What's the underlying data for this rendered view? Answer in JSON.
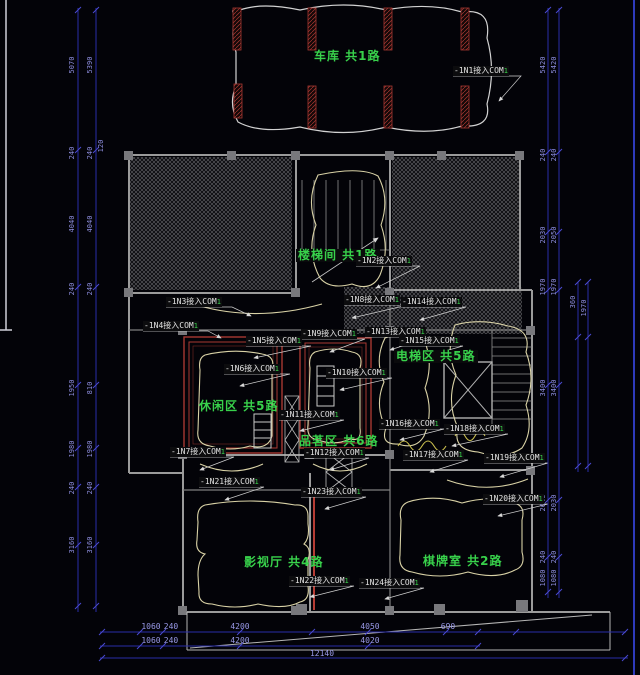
{
  "drawing": {
    "type": "electrical-floor-plan",
    "colors": {
      "room_label_green": "#38d14b",
      "wiring_red": "#a83832",
      "dimension_blue": "#2a2da8",
      "line_white": "#d6d6d6"
    }
  },
  "rooms": [
    {
      "label": "车库 共1路"
    },
    {
      "label": "楼梯间 共1路"
    },
    {
      "label": "电梯区 共5路"
    },
    {
      "label": "休闲区 共5路"
    },
    {
      "label": "品茗区 共6路"
    },
    {
      "label": "影视厅 共4路"
    },
    {
      "label": "棋牌室 共2路"
    }
  ],
  "circuits": [
    {
      "text": "-1N1接入COM",
      "sfx": "1"
    },
    {
      "text": "-1N2接入COM",
      "sfx": "1"
    },
    {
      "text": "-1N3接入COM",
      "sfx": "1"
    },
    {
      "text": "-1N4接入COM",
      "sfx": "1"
    },
    {
      "text": "-1N5接入COM",
      "sfx": "1"
    },
    {
      "text": "-1N6接入COM",
      "sfx": "1"
    },
    {
      "text": "-1N7接入COM",
      "sfx": "1"
    },
    {
      "text": "-1N8接入COM",
      "sfx": "1"
    },
    {
      "text": "-1N9接入COM",
      "sfx": "1"
    },
    {
      "text": "-1N10接入COM",
      "sfx": "1"
    },
    {
      "text": "-1N11接入COM",
      "sfx": "1"
    },
    {
      "text": "-1N12接入COM",
      "sfx": "1"
    },
    {
      "text": "-1N13接入COM",
      "sfx": "1"
    },
    {
      "text": "-1N14接入COM",
      "sfx": "1"
    },
    {
      "text": "-1N15接入COM",
      "sfx": "1"
    },
    {
      "text": "-1N16接入COM",
      "sfx": "1"
    },
    {
      "text": "-1N17接入COM",
      "sfx": "1"
    },
    {
      "text": "-1N18接入COM",
      "sfx": "1"
    },
    {
      "text": "-1N19接入COM",
      "sfx": "1"
    },
    {
      "text": "-1N20接入COM",
      "sfx": "1"
    },
    {
      "text": "-1N21接入COM",
      "sfx": "1"
    },
    {
      "text": "-1N22接入COM",
      "sfx": "1"
    },
    {
      "text": "-1N23接入COM",
      "sfx": "1"
    },
    {
      "text": "-1N24接入COM",
      "sfx": "1"
    }
  ],
  "dims": {
    "left_a": [
      "5070",
      "240",
      "4040",
      "240",
      "1950",
      "1980",
      "240",
      "3160"
    ],
    "left_b": [
      "5390",
      "240",
      "4040",
      "240",
      "810",
      "1980",
      "240",
      "3160"
    ],
    "left_extra": "120",
    "right_a": [
      "5420",
      "240",
      "2030",
      "1970",
      "3400",
      "2640",
      "240",
      "1080"
    ],
    "right_b": [
      "5420",
      "240",
      "2050",
      "1970",
      "3400",
      "2030",
      "240",
      "1080"
    ],
    "right_inner_a": "360",
    "right_inner_b": "1970",
    "bottom_row1": [
      "1060",
      "240",
      "4200",
      "4050",
      "690"
    ],
    "bottom_row2": [
      "1060",
      "240",
      "4200",
      "4020"
    ],
    "bottom_total": "12140"
  }
}
